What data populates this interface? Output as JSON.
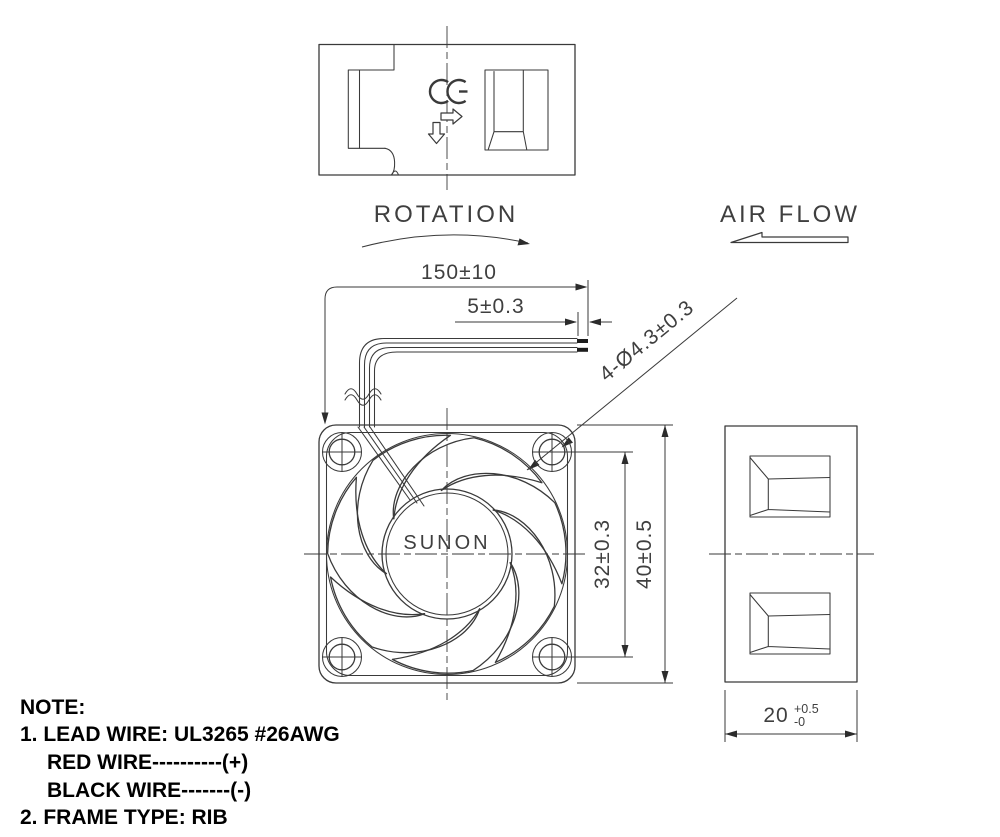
{
  "labels": {
    "rotation": "ROTATION",
    "airflow": "AIR FLOW",
    "brand": "SUNON"
  },
  "dimensions": {
    "lead_wire_length": "150±10",
    "strip_length": "5±0.3",
    "mounting_hole_callout": "4-Ø4.3±0.3",
    "hole_pitch": "32±0.3",
    "frame_size": "40±0.5",
    "frame_depth": "20",
    "frame_depth_tol_upper": "+0.5",
    "frame_depth_tol_lower": "-0"
  },
  "note": {
    "heading": "NOTE:",
    "lines": [
      "1. LEAD WIRE: UL3265 #26AWG",
      "RED WIRE----------(+)",
      "BLACK WIRE-------(-)",
      "2. FRAME TYPE: RIB"
    ]
  },
  "colors": {
    "line": "#3a3a3a",
    "dimension_text": "#3f3f3f",
    "note_text": "#000000",
    "background": "#ffffff"
  }
}
